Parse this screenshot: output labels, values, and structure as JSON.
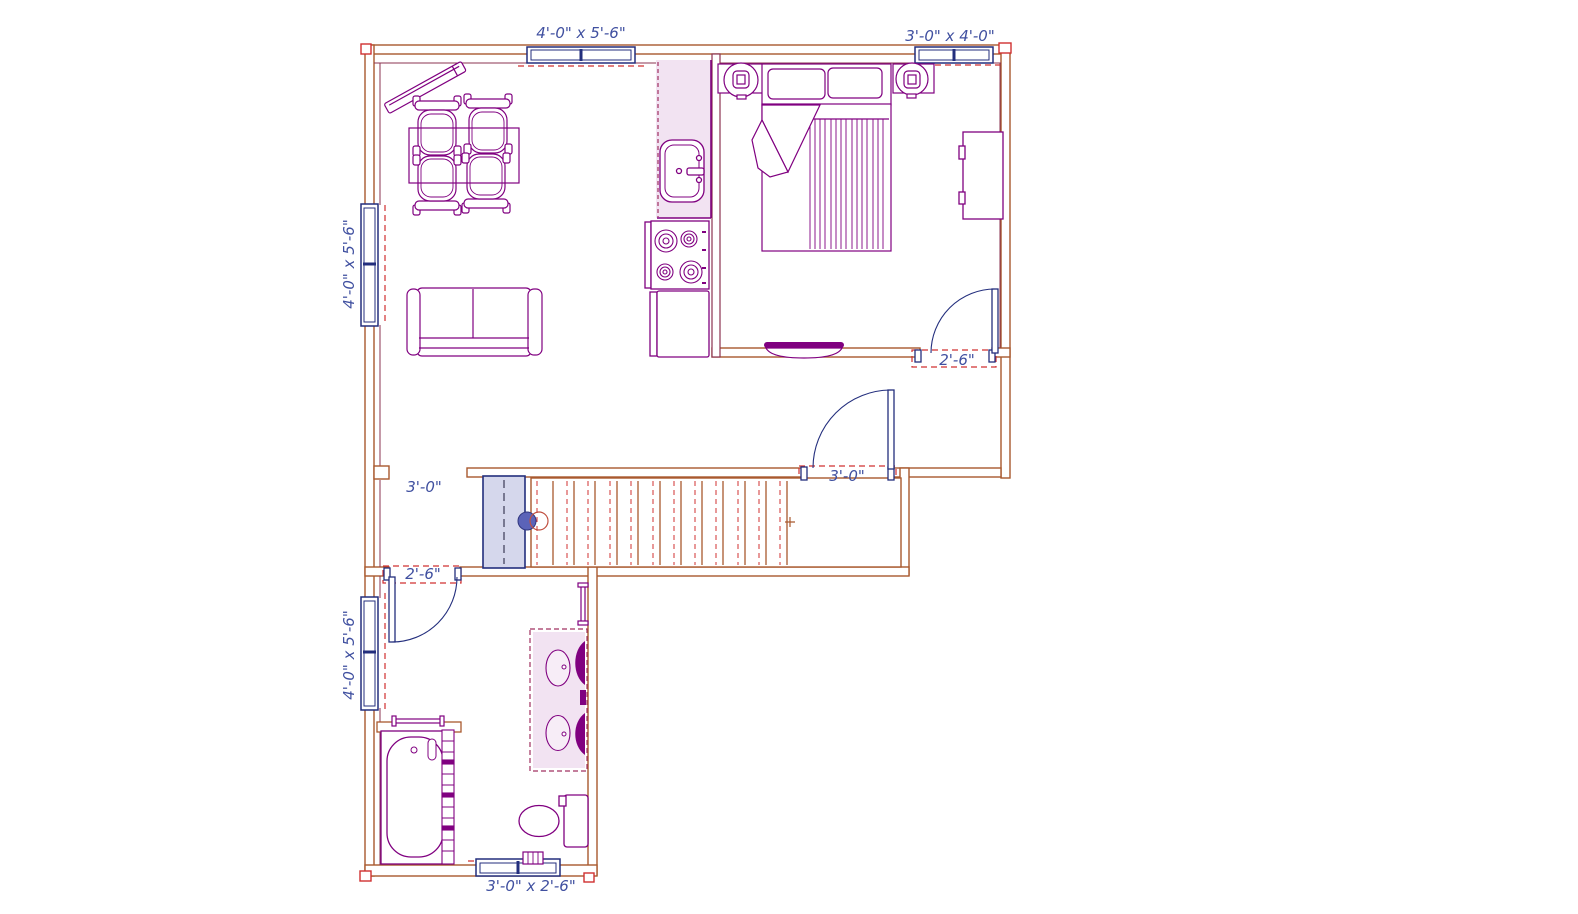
{
  "app": {
    "canvas_name": "floor-plan-drawing"
  },
  "colors": {
    "wall": "#A9592E",
    "interior_wall": "#8B3350",
    "furniture": "#800080",
    "window_door": "#232E7D",
    "dashed_marker": "#D03030",
    "cabinet_fill": "#F2E3F2",
    "stair_door_fill": "#D5D7EC",
    "label_text": "#4050A0"
  },
  "labels": {
    "window_top_left": "4'-0\" x 5'-6\"",
    "window_top_right": "3'-0\" x 4'-0\"",
    "window_left_upper": "4'-0\" x 5'-6\"",
    "window_left_lower": "4'-0\" x 5'-6\"",
    "window_bottom": "3'-0\" x 2'-6\"",
    "door_entry": "3'-0\"",
    "door_bedroom": "2'-6\"",
    "door_bathroom": "2'-6\"",
    "opening_hall": "3'-0\""
  },
  "stairs": {
    "tread_count": 12
  }
}
